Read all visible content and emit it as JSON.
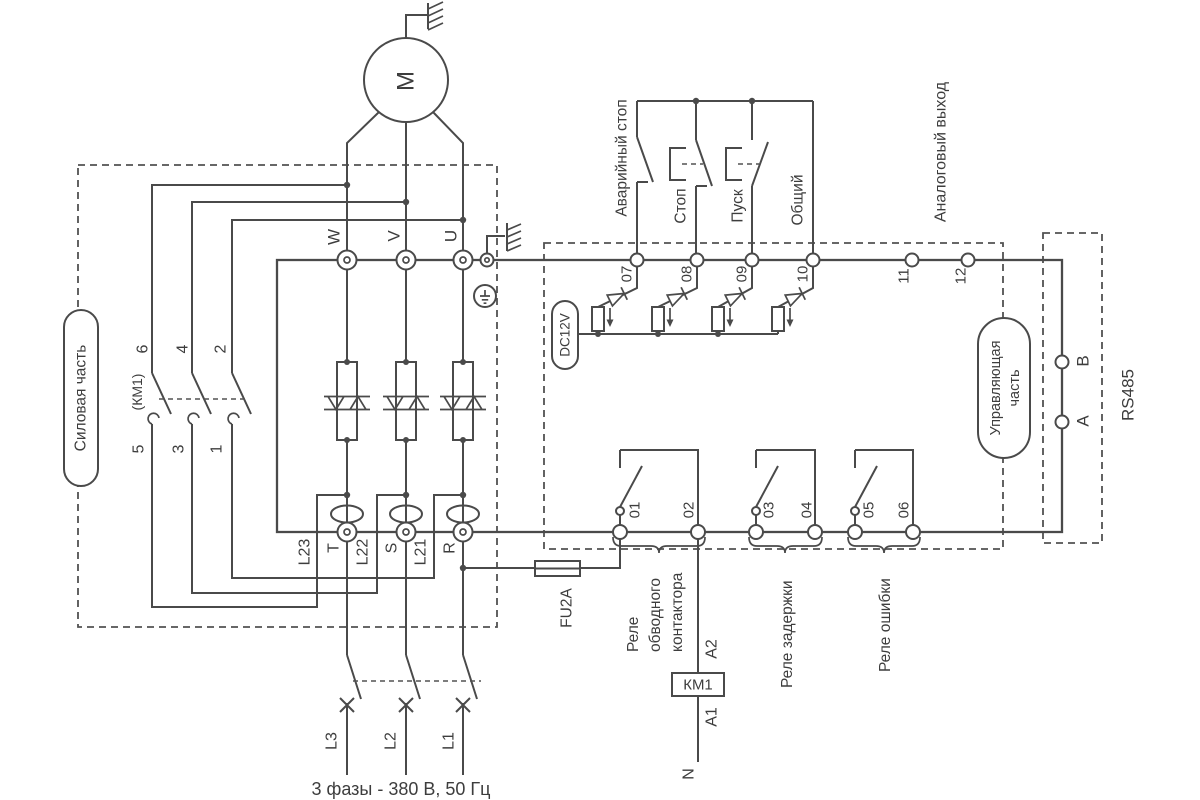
{
  "power": {
    "section_label": "Силовая часть",
    "motor_label": "М",
    "output_terminals": [
      "W",
      "V",
      "U"
    ],
    "bypass_contactor": {
      "designation": "(КМ1)",
      "top_pins": [
        "6",
        "4",
        "2"
      ],
      "bottom_pins": [
        "5",
        "3",
        "1"
      ]
    },
    "input_terminals": [
      {
        "code": "L23",
        "pin": "T"
      },
      {
        "code": "L22",
        "pin": "S"
      },
      {
        "code": "L21",
        "pin": "R"
      }
    ],
    "phases": [
      "L3",
      "L2",
      "L1"
    ],
    "supply_note": "3 фазы - 380 В, 50 Гц",
    "fuse_label": "FU2A"
  },
  "control": {
    "section_label": [
      "Управляющая",
      "часть"
    ],
    "digital_inputs": {
      "labels": [
        "Аварийный стоп",
        "Стоп",
        "Пуск",
        "Общий"
      ],
      "terminals": [
        "07",
        "08",
        "09",
        "10"
      ],
      "supply_label": "DC12V"
    },
    "analog_output": {
      "label": "Аналоговый выход",
      "terminals": [
        "11",
        "12"
      ]
    },
    "relay_outputs": {
      "terminals": [
        "01",
        "02",
        "03",
        "04",
        "05",
        "06"
      ],
      "bypass_relay": [
        "Реле",
        "обводного",
        "контактора"
      ],
      "delay_relay": "Реле задержки",
      "error_relay": "Реле ошибки"
    }
  },
  "contactor_coil": {
    "label": "КМ1",
    "terminal_top": "A2",
    "terminal_bottom": "A1",
    "neutral": "N"
  },
  "rs485": {
    "label": "RS485",
    "terminals": [
      "B",
      "A"
    ]
  },
  "colors": {
    "line": "#4a4a4a",
    "text": "#3d3d3d",
    "background": "#ffffff"
  }
}
